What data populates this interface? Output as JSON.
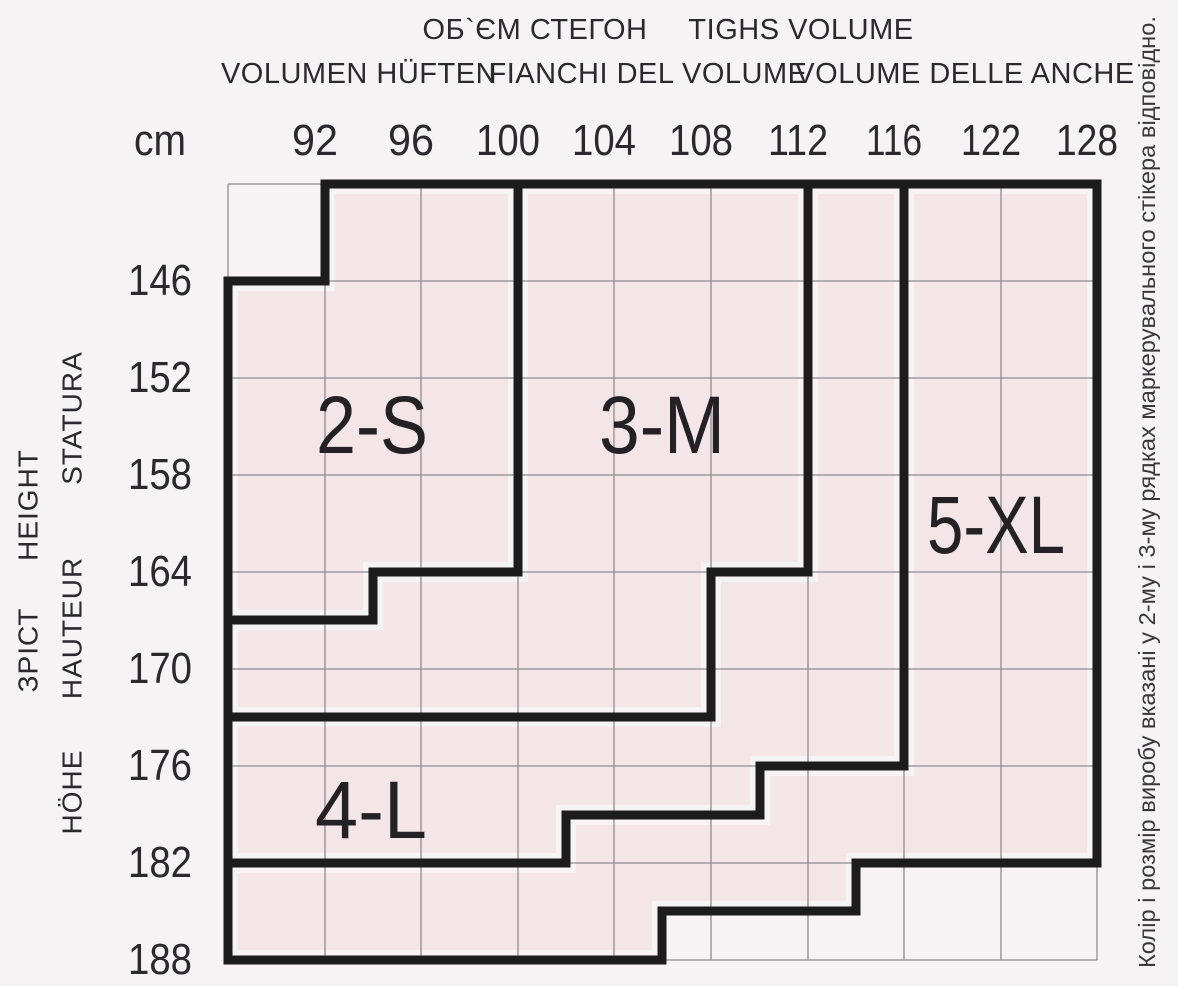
{
  "header": {
    "row1": {
      "uk": "ОБ`ЄМ СТЕГОН",
      "en": "TIGHS VOLUME"
    },
    "row2": {
      "de": "VOLUMEN HÜFTEN",
      "it_fianchi": "FIANCHI DEL VOLUME",
      "it_anche": "VOLUME DELLE ANCHE"
    }
  },
  "unit_label": "cm",
  "hip_columns": [
    "92",
    "96",
    "100",
    "104",
    "108",
    "112",
    "116",
    "122",
    "128"
  ],
  "height_rows": [
    "146",
    "152",
    "158",
    "164",
    "170",
    "176",
    "182",
    "188"
  ],
  "height_axis_labels": {
    "uk": "ЗРІСТ",
    "en": "HEIGHT",
    "fr": "HAUTEUR",
    "de": "HÖHE",
    "it": "STATURA"
  },
  "sizes": {
    "s": "2-S",
    "m": "3-M",
    "l": "4-L",
    "xl": "5-XL"
  },
  "side_note": "Колір і розмір виробу вказані у 2-му і 3-му рядках маркерувального стікера відповідно.",
  "colors": {
    "background": "#f5f3f4",
    "zone_fill": "#f3e5e8",
    "grid_line": "#8f8b8f",
    "zone_border": "#1d1c1d",
    "text": "#2b292c"
  },
  "chart_data": {
    "type": "heatmap",
    "title": "ОБ`ЄМ СТЕГОН / TIGHS VOLUME — hip volume (cm) vs height (cm) size zones",
    "x_axis_titles": [
      "ОБ`ЄМ СТЕГОН",
      "TIGHS VOLUME",
      "VOLUMEN HÜFTEN",
      "FIANCHI DEL VOLUME",
      "VOLUME DELLE ANCHE"
    ],
    "x_unit": "cm",
    "x_ticks": [
      92,
      96,
      100,
      104,
      108,
      112,
      116,
      122,
      128
    ],
    "y_axis_titles": [
      "ЗРІСТ",
      "HEIGHT",
      "HAUTEUR",
      "HÖHE",
      "STATURA"
    ],
    "y_ticks": [
      146,
      152,
      158,
      164,
      170,
      176,
      182,
      188
    ],
    "grid": true,
    "legend_position": "in-zone labels",
    "zones": [
      {
        "size": "2-S",
        "vertices_hip_height": [
          [
            92,
            "top"
          ],
          [
            100,
            "top"
          ],
          [
            100,
            164
          ],
          [
            94,
            164
          ],
          [
            94,
            167
          ],
          [
            "left-edge",
            167
          ],
          [
            "left-edge",
            146
          ],
          [
            92,
            146
          ]
        ]
      },
      {
        "size": "3-M",
        "vertices_hip_height": [
          [
            100,
            "top"
          ],
          [
            112,
            "top"
          ],
          [
            112,
            164
          ],
          [
            108,
            164
          ],
          [
            108,
            173
          ],
          [
            "left-edge",
            173
          ],
          [
            "left-edge",
            167
          ],
          [
            94,
            167
          ],
          [
            94,
            164
          ],
          [
            100,
            164
          ]
        ]
      },
      {
        "size": "4-L",
        "vertices_hip_height": [
          [
            "left-edge",
            173
          ],
          [
            108,
            173
          ],
          [
            108,
            164
          ],
          [
            112,
            164
          ],
          [
            112,
            "top"
          ],
          [
            116,
            "top"
          ],
          [
            116,
            176
          ],
          [
            110,
            176
          ],
          [
            110,
            179
          ],
          [
            102,
            179
          ],
          [
            102,
            182
          ],
          [
            "left-edge",
            182
          ]
        ]
      },
      {
        "size": "5-XL",
        "vertices_hip_height": [
          [
            116,
            "top"
          ],
          [
            128,
            "top"
          ],
          [
            128,
            182
          ],
          [
            114,
            182
          ],
          [
            114,
            185
          ],
          [
            106,
            185
          ],
          [
            106,
            188
          ],
          [
            "left-edge",
            188
          ],
          [
            "left-edge",
            182
          ],
          [
            102,
            182
          ],
          [
            102,
            179
          ],
          [
            110,
            179
          ],
          [
            110,
            176
          ],
          [
            116,
            176
          ]
        ]
      }
    ],
    "notes": "Grid has one unlabeled edge line left of 92 and one above 146; bottom edge is 188. Step values 94, 102, 106, 110, 114 (hips) and 167, 173, 179, 185 (heights) are half-cell boundary steps. Top-left cell and bottom-right corner cells are outside all size zones."
  }
}
